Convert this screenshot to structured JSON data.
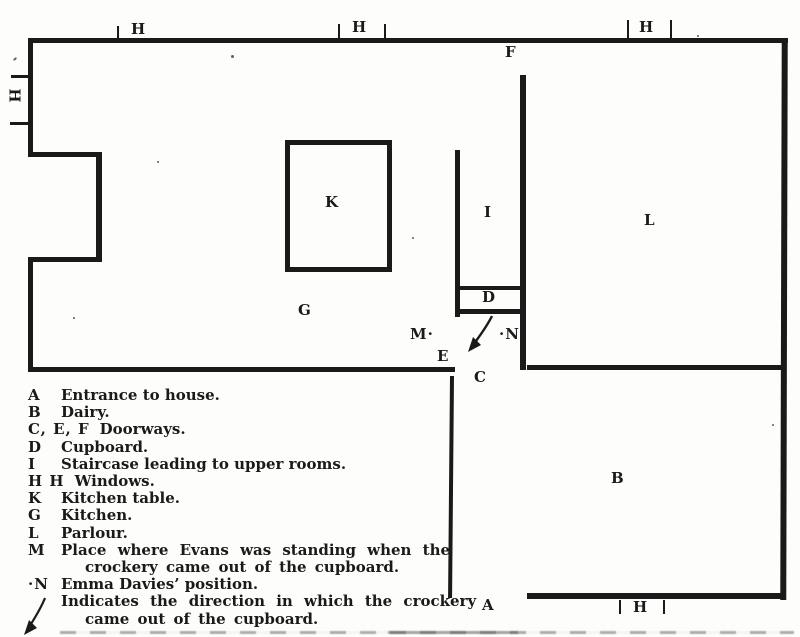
{
  "figure": {
    "kind": "scanned floor plan with legend",
    "ink_color": "#1a1a1a",
    "paper_color": "#fdfdfb"
  },
  "plan": {
    "labels": [
      {
        "id": "window-top-1",
        "text": "H",
        "x": 131,
        "y": 22
      },
      {
        "id": "window-top-2",
        "text": "H",
        "x": 352,
        "y": 20
      },
      {
        "id": "window-top-3",
        "text": "H",
        "x": 639,
        "y": 20
      },
      {
        "id": "window-left",
        "text": "H",
        "x": 7,
        "y": 89,
        "rot": 90
      },
      {
        "id": "window-bottom",
        "text": "H",
        "x": 633,
        "y": 600
      },
      {
        "id": "doorway-f",
        "text": "F",
        "x": 505,
        "y": 45
      },
      {
        "id": "kitchen-table",
        "text": "K",
        "x": 325,
        "y": 195
      },
      {
        "id": "staircase",
        "text": "I",
        "x": 484,
        "y": 205
      },
      {
        "id": "parlour",
        "text": "L",
        "x": 644,
        "y": 213
      },
      {
        "id": "kitchen",
        "text": "G",
        "x": 298,
        "y": 303
      },
      {
        "id": "cupboard",
        "text": "D",
        "x": 482,
        "y": 290
      },
      {
        "id": "evans-position",
        "text": "M·",
        "x": 410,
        "y": 327
      },
      {
        "id": "davies-position",
        "text": "·N",
        "x": 499,
        "y": 327
      },
      {
        "id": "doorway-e",
        "text": "E",
        "x": 437,
        "y": 349
      },
      {
        "id": "doorway-c",
        "text": "C",
        "x": 474,
        "y": 370
      },
      {
        "id": "dairy",
        "text": "B",
        "x": 611,
        "y": 471
      },
      {
        "id": "entrance-a",
        "text": "A",
        "x": 482,
        "y": 598
      }
    ]
  },
  "legend": {
    "items": [
      {
        "key": "A",
        "text": "Entrance to house."
      },
      {
        "key": "B",
        "text": "Dairy."
      },
      {
        "key": "C, E, F",
        "text": "Doorways."
      },
      {
        "key": "D",
        "text": "Cupboard."
      },
      {
        "key": "I",
        "text": "Staircase leading to upper rooms."
      },
      {
        "key": "H H",
        "text": "Windows."
      },
      {
        "key": "K",
        "text": "Kitchen table."
      },
      {
        "key": "G",
        "text": "Kitchen."
      },
      {
        "key": "L",
        "text": "Parlour."
      },
      {
        "key": "M",
        "text": "Place where Evans was standing when the",
        "text2": "crockery came out of the cupboard.",
        "justify": true
      },
      {
        "key": "·N",
        "text": "Emma Davies’ position."
      },
      {
        "key": "arrow",
        "key_type": "arrow-icon",
        "text": "Indicates the direction in which the crockery",
        "text2": "came out of the cupboard.",
        "justify": true
      }
    ]
  }
}
